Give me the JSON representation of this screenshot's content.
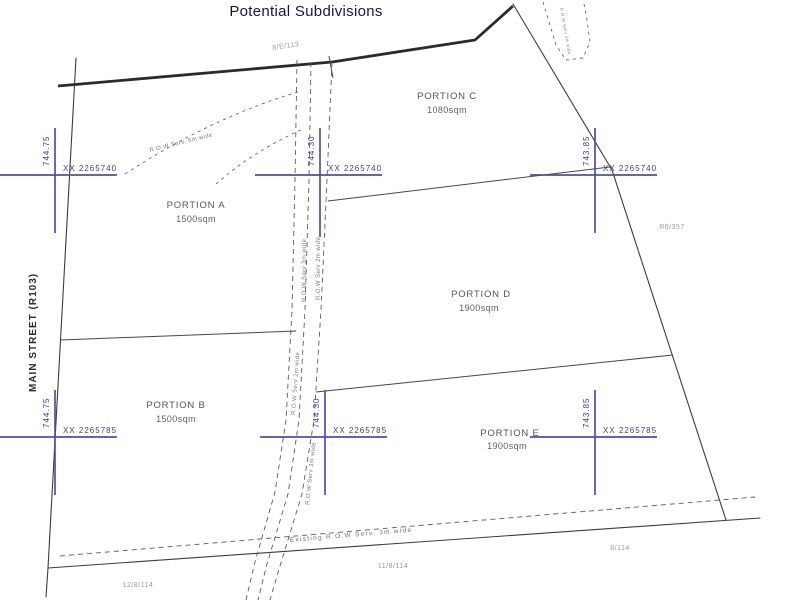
{
  "title": "Potential Subdivisions",
  "street_label": "MAIN STREET (R103)",
  "portions": [
    {
      "name": "PORTION A",
      "area": "1500sqm"
    },
    {
      "name": "PORTION B",
      "area": "1500sqm"
    },
    {
      "name": "PORTION C",
      "area": "1080sqm"
    },
    {
      "name": "PORTION D",
      "area": "1900sqm"
    },
    {
      "name": "PORTION E",
      "area": "1900sqm"
    }
  ],
  "grid_crosses": [
    {
      "position": "top-left",
      "easting": "XX 2265740",
      "level": "744.75"
    },
    {
      "position": "top-middle",
      "easting": "XX 2265740",
      "level": "744.30"
    },
    {
      "position": "top-right",
      "easting": "XX 2265740",
      "level": "743.85"
    },
    {
      "position": "bottom-left",
      "easting": "XX 2265785",
      "level": "744.75"
    },
    {
      "position": "bottom-middle",
      "easting": "XX 2265785",
      "level": "744.30"
    },
    {
      "position": "bottom-right",
      "easting": "XX 2265785",
      "level": "743.85"
    }
  ],
  "row_labels": {
    "top_curve": "R.O.W Serv. 6m wide",
    "road_1": "R.O.W Serv 3m wide",
    "road_2": "R.O.W Serv 2m wide",
    "road_3": "R.O.W Serv 2m wide",
    "road_4": "R.O.W Serv 3m wide",
    "pocket": "R.O.W Serv 3m wide",
    "bottom_road": "Existing R.O.W Serv. 3m wide"
  },
  "parcel_refs": {
    "top": "8/E/113",
    "right": "R6/357",
    "bottom_right": "8/114",
    "bottom_middle": "11/8/114",
    "bottom_left": "12/8/114"
  },
  "colors": {
    "boundary": "#3c3c3c",
    "cross": "#4a4fae",
    "cross_label": "#3c3c96",
    "title": "#15154d",
    "small_text": "#9a9a9a",
    "portion_text": "#555555"
  }
}
